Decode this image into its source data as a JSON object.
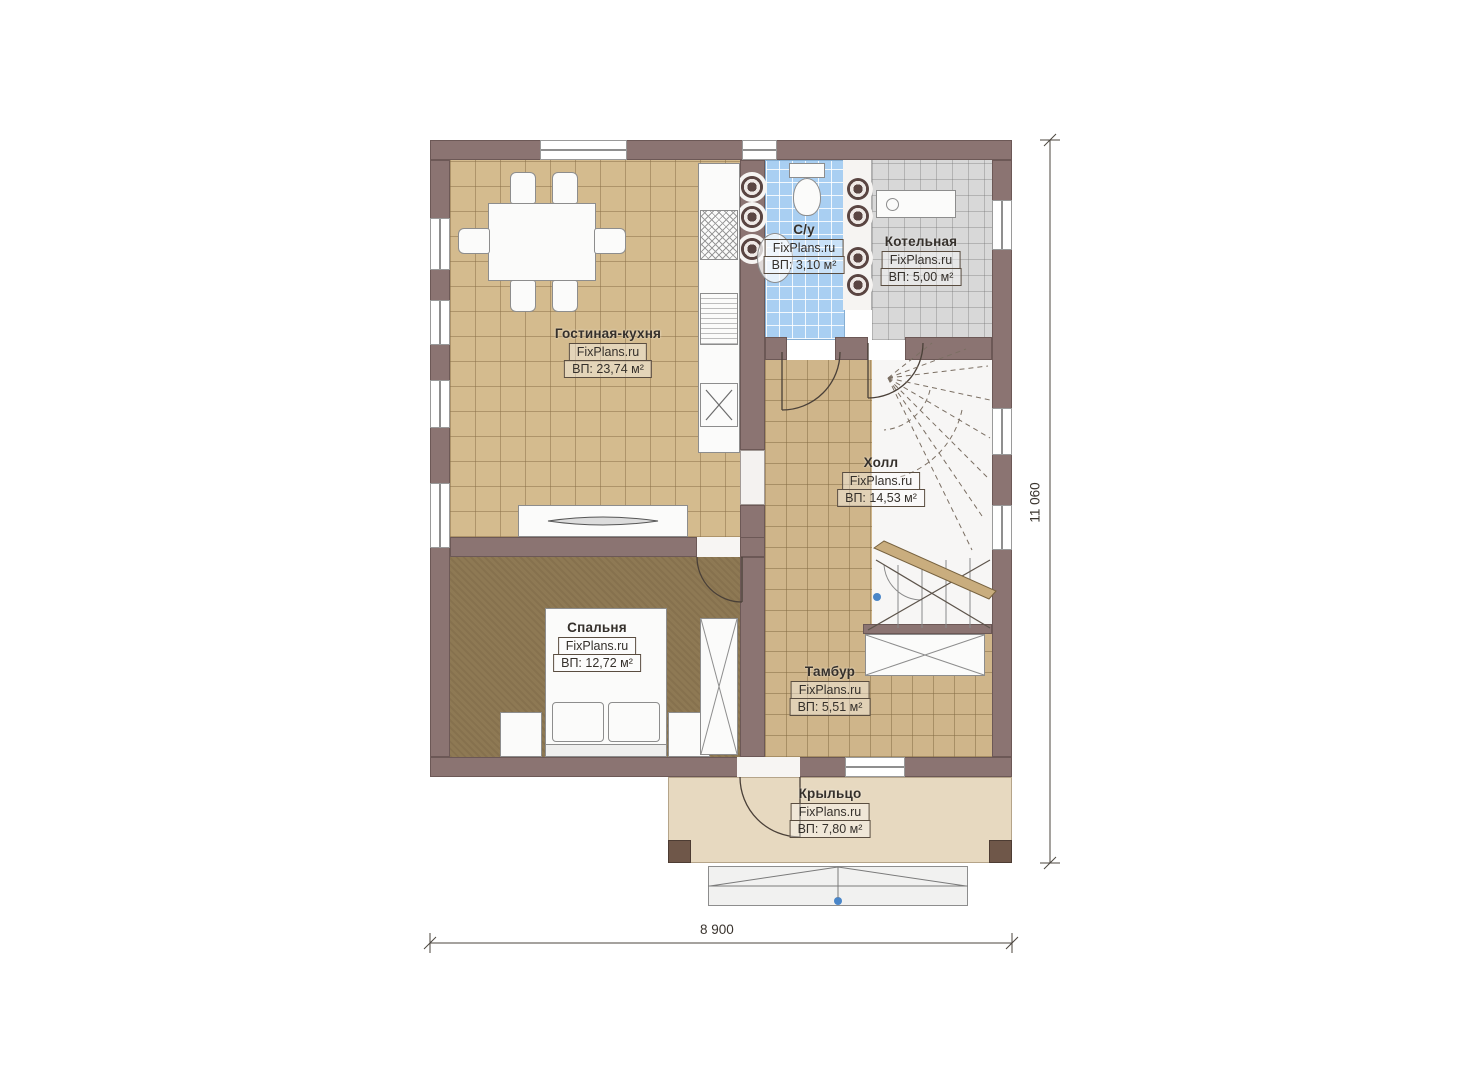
{
  "plan": {
    "title_note": "floor plan first storey",
    "rooms": [
      {
        "id": "living-kitchen",
        "name": "Гостиная-кухня",
        "brand": "FixPlans.ru",
        "area": "ВП: 23,74 м²"
      },
      {
        "id": "bathroom",
        "name": "С/у",
        "brand": "FixPlans.ru",
        "area": "ВП: 3,10 м²"
      },
      {
        "id": "boiler",
        "name": "Котельная",
        "brand": "FixPlans.ru",
        "area": "ВП: 5,00 м²"
      },
      {
        "id": "hall",
        "name": "Холл",
        "brand": "FixPlans.ru",
        "area": "ВП: 14,53 м²"
      },
      {
        "id": "bedroom",
        "name": "Спальня",
        "brand": "FixPlans.ru",
        "area": "ВП: 12,72 м²"
      },
      {
        "id": "vestibule",
        "name": "Тамбур",
        "brand": "FixPlans.ru",
        "area": "ВП: 5,51 м²"
      },
      {
        "id": "porch",
        "name": "Крыльцо",
        "brand": "FixPlans.ru",
        "area": "ВП: 7,80 м²"
      }
    ],
    "dimensions": {
      "width": "8 900",
      "height": "11 060"
    },
    "palette": {
      "wall": "#8b7472",
      "floor_tile_tan": "#d4bb8e",
      "floor_bedroom": "#8e7954",
      "floor_bathroom": "#a9cff2",
      "floor_boiler": "#d8d8d8",
      "porch": "#e7d9c0",
      "marker_blue": "#4a86c8"
    }
  }
}
